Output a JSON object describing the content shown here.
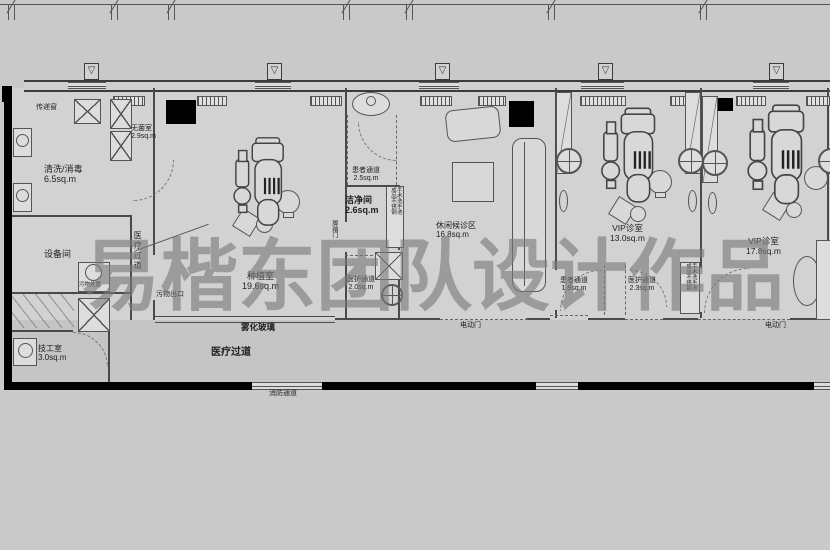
{
  "watermark": "易楷东团队设计作品",
  "rooms": {
    "wash": {
      "name": "清洗/消毒",
      "area": "6.5sq.m"
    },
    "sterile": {
      "name": "无菌室",
      "area": "2.9sq.m"
    },
    "equipment": {
      "name": "设备间"
    },
    "technician": {
      "name": "技工室",
      "area": "3.0sq.m"
    },
    "implant": {
      "name": "种植室",
      "area": "19.6sq.m"
    },
    "clean": {
      "name": "洁净间",
      "area": "2.6sq.m"
    },
    "waiting": {
      "name": "休闲候诊区",
      "area": "16.8sq.m"
    },
    "vip1": {
      "name": "VIP诊室",
      "area": "13.0sq.m"
    },
    "vip2": {
      "name": "VIP诊室",
      "area": "17.8sq.m"
    }
  },
  "passages": {
    "patient_mid": {
      "name": "患者通道",
      "area": "2.5sq.m"
    },
    "staff_mid": {
      "name": "医护通道",
      "area": "2.0sq.m"
    },
    "patient_right": {
      "name": "患者通道",
      "area": "1.9sq.m"
    },
    "staff_right": {
      "name": "医护通道",
      "area": "2.3sq.m"
    },
    "medical_corridor_vertical": "医疗过道",
    "medical_corridor": "医疗过道",
    "fire": "消防通道"
  },
  "annotations": {
    "pass_window": "传递窗",
    "waste_exit": "污物出口",
    "waste_disposal": "污物处置",
    "fog_glass": "雾化玻璃",
    "foot_door": "脚踏门",
    "electric_door": "电动门"
  },
  "fixtures": {
    "scrub_sink": {
      "line1": "成品不锈钢",
      "line2": "手术洗手池"
    }
  },
  "colors": {
    "background": "#c9c9c9",
    "room_fill": "#d2d2d2",
    "corridor_fill": "#c5c5c5",
    "wall": "#000000",
    "line": "#4a4a4a",
    "watermark": "#7b7b7b"
  }
}
